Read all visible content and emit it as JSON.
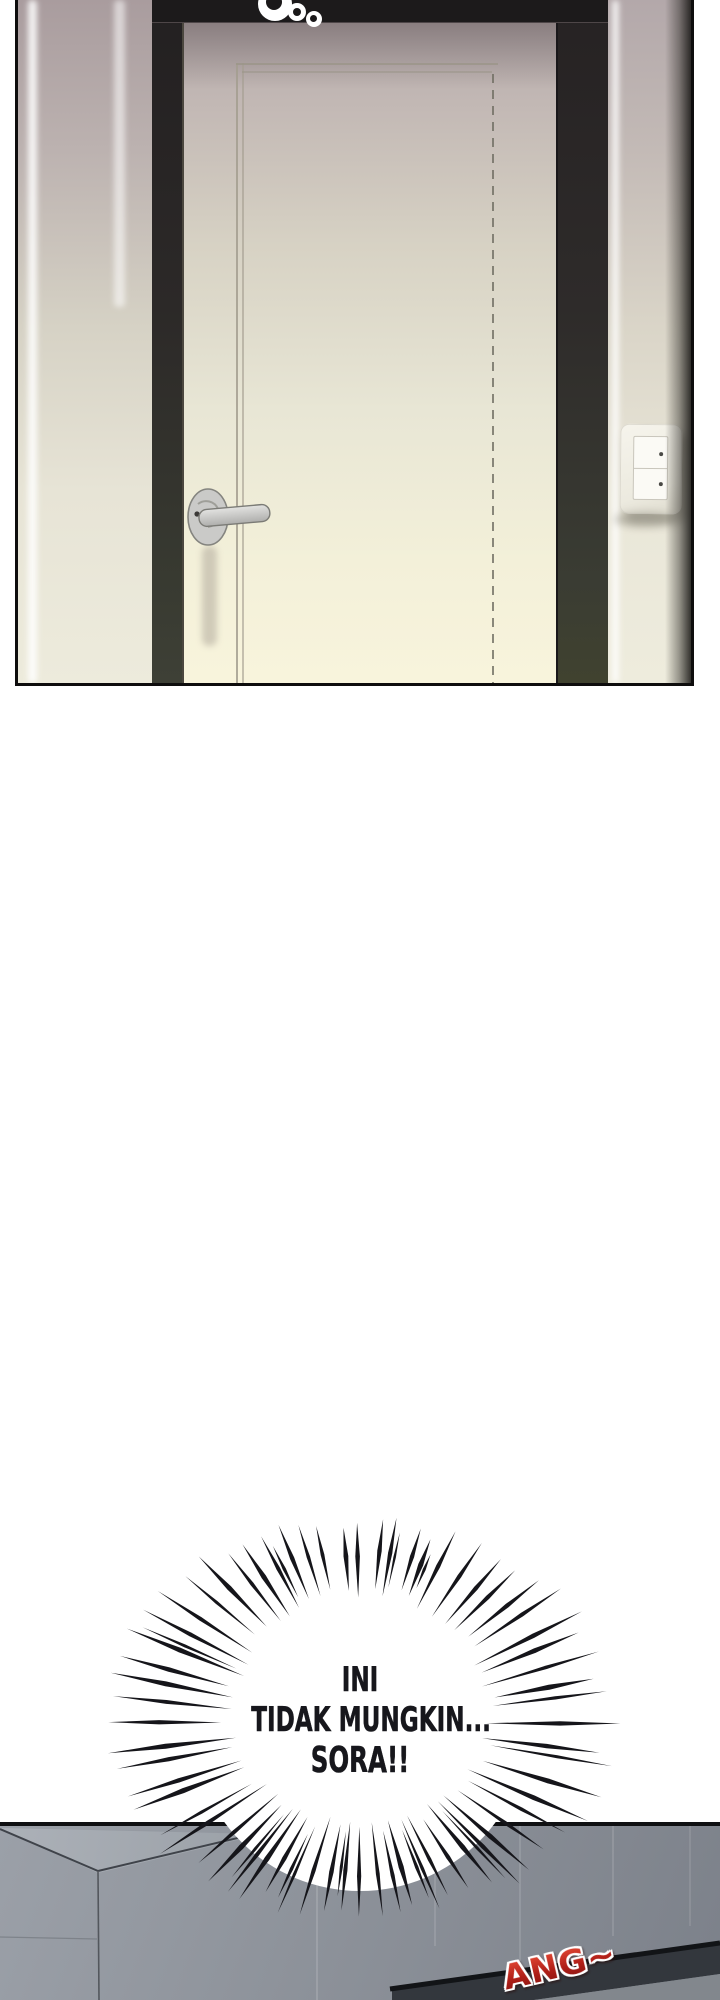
{
  "page": {
    "background_color": "#ffffff",
    "type_label": "webtoon-comic-page"
  },
  "door_panel": {
    "rings_sfx_icon": "sound-rings",
    "colors": {
      "wall_top": "#a99c9e",
      "wall_bottom": "#edebdc",
      "door_top": "#b2a6a8",
      "door_bottom": "#f8f4dc",
      "frame_dark": "#262223",
      "panel_border": "#0e0d0d"
    }
  },
  "shout_burst": {
    "lines": [
      "INI",
      "TIDAK MUNGKIN...",
      "SORA!!"
    ],
    "text_color": "#17171c",
    "bubble_color": "#ffffff",
    "line_color": "#15151a"
  },
  "room_panel": {
    "sfx": {
      "text": "ANG~",
      "color": "#b01f18",
      "outline_color": "#ffffff"
    },
    "colors": {
      "wall": "#8d929a",
      "corner_surface": "#acb1b8",
      "beam_dark": "#33373d"
    }
  }
}
